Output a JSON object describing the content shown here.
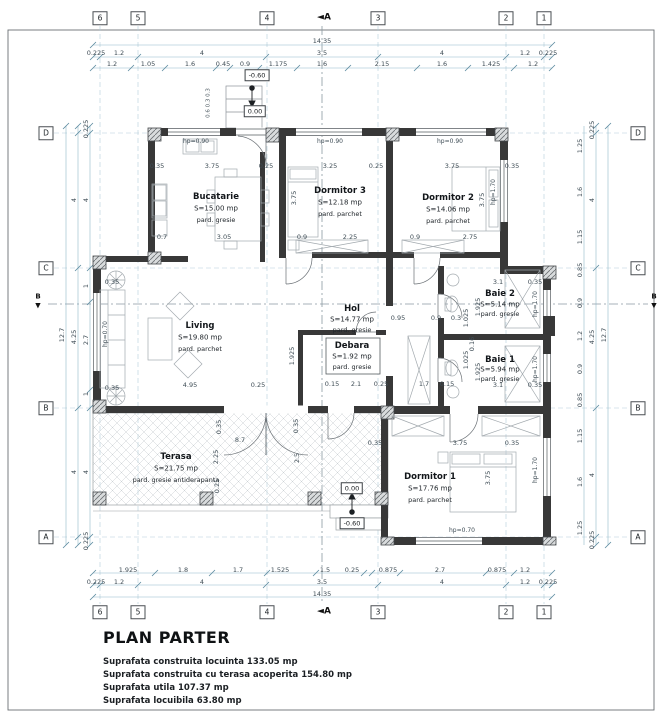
{
  "title_block": {
    "title": "PLAN PARTER",
    "lines": [
      "Suprafata construita locuinta 133.05 mp",
      "Suprafata construita cu terasa acoperita 154.80 mp",
      "Suprafata utila 107.37 mp",
      "Suprafata locuibila 63.80 mp"
    ]
  },
  "plan_labels": {
    "grid_bubbles": [
      {
        "t": "6",
        "x": 100,
        "y": 18
      },
      {
        "t": "5",
        "x": 138,
        "y": 18
      },
      {
        "t": "4",
        "x": 267,
        "y": 18
      },
      {
        "t": "3",
        "x": 378,
        "y": 18
      },
      {
        "t": "2",
        "x": 506,
        "y": 18
      },
      {
        "t": "1",
        "x": 544,
        "y": 18
      },
      {
        "t": "6",
        "x": 100,
        "y": 612
      },
      {
        "t": "5",
        "x": 138,
        "y": 612
      },
      {
        "t": "4",
        "x": 267,
        "y": 612
      },
      {
        "t": "3",
        "x": 378,
        "y": 612
      },
      {
        "t": "2",
        "x": 506,
        "y": 612
      },
      {
        "t": "1",
        "x": 544,
        "y": 612
      },
      {
        "t": "D",
        "x": 46,
        "y": 133
      },
      {
        "t": "C",
        "x": 46,
        "y": 268
      },
      {
        "t": "B",
        "x": 46,
        "y": 408
      },
      {
        "t": "A",
        "x": 46,
        "y": 537
      },
      {
        "t": "D",
        "x": 638,
        "y": 133
      },
      {
        "t": "C",
        "x": 638,
        "y": 268
      },
      {
        "t": "B",
        "x": 638,
        "y": 408
      },
      {
        "t": "A",
        "x": 638,
        "y": 537
      }
    ],
    "section_markers": [
      {
        "t": "◄A",
        "x": 324,
        "y": 18
      },
      {
        "t": "◄A",
        "x": 324,
        "y": 612
      }
    ],
    "section_small": [
      {
        "t": "B",
        "x": 38,
        "y": 297
      },
      {
        "t": "▼",
        "x": 38,
        "y": 306
      },
      {
        "t": "B",
        "x": 654,
        "y": 297
      },
      {
        "t": "▼",
        "x": 654,
        "y": 306
      }
    ],
    "room_names": [
      {
        "t": "Bucatarie",
        "x": 216,
        "y": 197
      },
      {
        "t": "Dormitor 3",
        "x": 340,
        "y": 191
      },
      {
        "t": "Dormitor 2",
        "x": 448,
        "y": 198
      },
      {
        "t": "Living",
        "x": 200,
        "y": 326
      },
      {
        "t": "Hol",
        "x": 352,
        "y": 309
      },
      {
        "t": "Debara",
        "x": 352,
        "y": 346
      },
      {
        "t": "Baie 2",
        "x": 500,
        "y": 294
      },
      {
        "t": "Baie 1",
        "x": 500,
        "y": 360
      },
      {
        "t": "Dormitor 1",
        "x": 430,
        "y": 477
      },
      {
        "t": "Terasa",
        "x": 176,
        "y": 457
      }
    ],
    "room_areas": [
      {
        "t": "S=15.00 mp",
        "x": 216,
        "y": 209
      },
      {
        "t": "S=12.18 mp",
        "x": 340,
        "y": 203
      },
      {
        "t": "S=14.06 mp",
        "x": 448,
        "y": 210
      },
      {
        "t": "S=19.80 mp",
        "x": 200,
        "y": 338
      },
      {
        "t": "S=14.77 mp",
        "x": 352,
        "y": 320
      },
      {
        "t": "S=1.92 mp",
        "x": 352,
        "y": 357
      },
      {
        "t": "S=5.14 mp",
        "x": 500,
        "y": 305
      },
      {
        "t": "S=5.94 mp",
        "x": 500,
        "y": 370
      },
      {
        "t": "S=17.76 mp",
        "x": 430,
        "y": 489
      },
      {
        "t": "S=21.75 mp",
        "x": 176,
        "y": 469
      }
    ],
    "room_floors": [
      {
        "t": "pard. gresie",
        "x": 216,
        "y": 220
      },
      {
        "t": "pard. parchet",
        "x": 340,
        "y": 214
      },
      {
        "t": "pard. parchet",
        "x": 448,
        "y": 221
      },
      {
        "t": "pard. parchet",
        "x": 200,
        "y": 349
      },
      {
        "t": "pard. gresie",
        "x": 352,
        "y": 330
      },
      {
        "t": "pard. gresie",
        "x": 352,
        "y": 367
      },
      {
        "t": "pard. gresie",
        "x": 500,
        "y": 314
      },
      {
        "t": "pard. gresie",
        "x": 500,
        "y": 379
      },
      {
        "t": "pard. parchet",
        "x": 430,
        "y": 500
      },
      {
        "t": "pard. gresie antiderapanta",
        "x": 176,
        "y": 480
      }
    ],
    "hp_labels": [
      {
        "t": "hp=0.90",
        "x": 196,
        "y": 142
      },
      {
        "t": "hp=0.90",
        "x": 330,
        "y": 142
      },
      {
        "t": "hp=0.90",
        "x": 450,
        "y": 142
      },
      {
        "t": "hp=1.70",
        "x": 494,
        "y": 192,
        "r": 1
      },
      {
        "t": "hp=1.70",
        "x": 536,
        "y": 304,
        "r": 1
      },
      {
        "t": "hp=1.70",
        "x": 536,
        "y": 369,
        "r": 1
      },
      {
        "t": "hp=1.70",
        "x": 536,
        "y": 470,
        "r": 1
      },
      {
        "t": "hp=0.70",
        "x": 462,
        "y": 531
      },
      {
        "t": "hp=0.70",
        "x": 106,
        "y": 334,
        "r": 1
      }
    ],
    "elev_labels": [
      {
        "t": "-0.60",
        "x": 257,
        "y": 75
      },
      {
        "t": "0.00",
        "x": 255,
        "y": 111
      },
      {
        "t": "0.00",
        "x": 352,
        "y": 488
      },
      {
        "t": "-0.60",
        "x": 352,
        "y": 523
      }
    ],
    "annotations": [
      {
        "t": "0.6  0.3 0.3",
        "x": 209,
        "y": 103,
        "r": 1
      }
    ],
    "dims": [
      {
        "t": "14.35",
        "x": 322,
        "y": 41
      },
      {
        "t": "0.225",
        "x": 96,
        "y": 53
      },
      {
        "t": "1.2",
        "x": 119,
        "y": 53
      },
      {
        "t": "4",
        "x": 202,
        "y": 53
      },
      {
        "t": "3.5",
        "x": 322,
        "y": 53
      },
      {
        "t": "4",
        "x": 442,
        "y": 53
      },
      {
        "t": "1.2",
        "x": 525,
        "y": 53
      },
      {
        "t": "0.225",
        "x": 548,
        "y": 53
      },
      {
        "t": "1.2",
        "x": 112,
        "y": 64
      },
      {
        "t": "1.05",
        "x": 148,
        "y": 64
      },
      {
        "t": "1.6",
        "x": 190,
        "y": 64
      },
      {
        "t": "0.45",
        "x": 223,
        "y": 64
      },
      {
        "t": "0.9",
        "x": 245,
        "y": 64
      },
      {
        "t": "1.175",
        "x": 278,
        "y": 64
      },
      {
        "t": "1.6",
        "x": 322,
        "y": 64
      },
      {
        "t": "2.15",
        "x": 382,
        "y": 64
      },
      {
        "t": "1.6",
        "x": 442,
        "y": 64
      },
      {
        "t": "1.425",
        "x": 491,
        "y": 64
      },
      {
        "t": "1.2",
        "x": 533,
        "y": 64
      },
      {
        "t": "1.925",
        "x": 128,
        "y": 570
      },
      {
        "t": "1.8",
        "x": 183,
        "y": 570
      },
      {
        "t": "1.7",
        "x": 238,
        "y": 570
      },
      {
        "t": "1.525",
        "x": 280,
        "y": 570
      },
      {
        "t": "1.5",
        "x": 325,
        "y": 570
      },
      {
        "t": "0.25",
        "x": 352,
        "y": 570
      },
      {
        "t": "0.875",
        "x": 388,
        "y": 570
      },
      {
        "t": "2.7",
        "x": 440,
        "y": 570
      },
      {
        "t": "0.875",
        "x": 497,
        "y": 570
      },
      {
        "t": "1.2",
        "x": 525,
        "y": 570
      },
      {
        "t": "0.225",
        "x": 96,
        "y": 582
      },
      {
        "t": "1.2",
        "x": 119,
        "y": 582
      },
      {
        "t": "4",
        "x": 202,
        "y": 582
      },
      {
        "t": "3.5",
        "x": 322,
        "y": 582
      },
      {
        "t": "4",
        "x": 442,
        "y": 582
      },
      {
        "t": "1.2",
        "x": 525,
        "y": 582
      },
      {
        "t": "0.225",
        "x": 548,
        "y": 582
      },
      {
        "t": "14.35",
        "x": 322,
        "y": 594
      },
      {
        "t": "0.225",
        "x": 86,
        "y": 129,
        "r": 1
      },
      {
        "t": "4",
        "x": 86,
        "y": 200,
        "r": 1
      },
      {
        "t": "1",
        "x": 86,
        "y": 286,
        "r": 1
      },
      {
        "t": "2.7",
        "x": 86,
        "y": 340,
        "r": 1
      },
      {
        "t": "1",
        "x": 86,
        "y": 394,
        "r": 1
      },
      {
        "t": "4",
        "x": 86,
        "y": 472,
        "r": 1
      },
      {
        "t": "0.225",
        "x": 86,
        "y": 541,
        "r": 1
      },
      {
        "t": "4",
        "x": 74,
        "y": 200,
        "r": 1
      },
      {
        "t": "4.25",
        "x": 74,
        "y": 337,
        "r": 1
      },
      {
        "t": "4",
        "x": 74,
        "y": 472,
        "r": 1
      },
      {
        "t": "12.7",
        "x": 62,
        "y": 335,
        "r": 1
      },
      {
        "t": "1.25",
        "x": 580,
        "y": 146,
        "r": 1
      },
      {
        "t": "1.6",
        "x": 580,
        "y": 192,
        "r": 1
      },
      {
        "t": "1.15",
        "x": 580,
        "y": 237,
        "r": 1
      },
      {
        "t": "0.85",
        "x": 580,
        "y": 270,
        "r": 1
      },
      {
        "t": "0.9",
        "x": 580,
        "y": 303,
        "r": 1
      },
      {
        "t": "1.2",
        "x": 580,
        "y": 336,
        "r": 1
      },
      {
        "t": "0.9",
        "x": 580,
        "y": 369,
        "r": 1
      },
      {
        "t": "0.85",
        "x": 580,
        "y": 400,
        "r": 1
      },
      {
        "t": "1.15",
        "x": 580,
        "y": 436,
        "r": 1
      },
      {
        "t": "1.6",
        "x": 580,
        "y": 482,
        "r": 1
      },
      {
        "t": "1.25",
        "x": 580,
        "y": 528,
        "r": 1
      },
      {
        "t": "0.225",
        "x": 592,
        "y": 130,
        "r": 1
      },
      {
        "t": "4",
        "x": 592,
        "y": 200,
        "r": 1
      },
      {
        "t": "4.25",
        "x": 592,
        "y": 337,
        "r": 1
      },
      {
        "t": "4",
        "x": 592,
        "y": 475,
        "r": 1
      },
      {
        "t": "0.225",
        "x": 592,
        "y": 540,
        "r": 1
      },
      {
        "t": "12.7",
        "x": 604,
        "y": 335,
        "r": 1
      },
      {
        "t": "0.35",
        "x": 157,
        "y": 166
      },
      {
        "t": "3.75",
        "x": 212,
        "y": 166
      },
      {
        "t": "0.25",
        "x": 266,
        "y": 166
      },
      {
        "t": "0.7",
        "x": 162,
        "y": 237
      },
      {
        "t": "3.05",
        "x": 224,
        "y": 237
      },
      {
        "t": "3.25",
        "x": 330,
        "y": 166
      },
      {
        "t": "0.25",
        "x": 376,
        "y": 166
      },
      {
        "t": "3.75",
        "x": 294,
        "y": 198,
        "r": 1
      },
      {
        "t": "0.9",
        "x": 302,
        "y": 237
      },
      {
        "t": "2.25",
        "x": 350,
        "y": 237
      },
      {
        "t": "3.75",
        "x": 452,
        "y": 166
      },
      {
        "t": "0.35",
        "x": 512,
        "y": 166
      },
      {
        "t": "0.9",
        "x": 415,
        "y": 237
      },
      {
        "t": "2.75",
        "x": 470,
        "y": 237
      },
      {
        "t": "3.75",
        "x": 482,
        "y": 200,
        "r": 1
      },
      {
        "t": "0.35",
        "x": 112,
        "y": 282
      },
      {
        "t": "4.95",
        "x": 190,
        "y": 385
      },
      {
        "t": "0.25",
        "x": 258,
        "y": 385
      },
      {
        "t": "0.35",
        "x": 112,
        "y": 388
      },
      {
        "t": "0.95",
        "x": 398,
        "y": 318
      },
      {
        "t": "0.9",
        "x": 436,
        "y": 318
      },
      {
        "t": "0.3",
        "x": 456,
        "y": 318
      },
      {
        "t": "0.15",
        "x": 332,
        "y": 384
      },
      {
        "t": "2.1",
        "x": 356,
        "y": 384
      },
      {
        "t": "0.25",
        "x": 381,
        "y": 384
      },
      {
        "t": "1.7",
        "x": 424,
        "y": 384
      },
      {
        "t": "0.15",
        "x": 447,
        "y": 384
      },
      {
        "t": "1.925",
        "x": 292,
        "y": 356,
        "r": 1
      },
      {
        "t": "3.1",
        "x": 498,
        "y": 282
      },
      {
        "t": "0.35",
        "x": 535,
        "y": 282
      },
      {
        "t": "3.1",
        "x": 498,
        "y": 385
      },
      {
        "t": "0.35",
        "x": 535,
        "y": 385
      },
      {
        "t": "1.925",
        "x": 478,
        "y": 307,
        "r": 1
      },
      {
        "t": "1.025",
        "x": 466,
        "y": 318,
        "r": 1
      },
      {
        "t": "0.16",
        "x": 472,
        "y": 344,
        "r": 1
      },
      {
        "t": "1.025",
        "x": 466,
        "y": 360,
        "r": 1
      },
      {
        "t": "1.925",
        "x": 478,
        "y": 372,
        "r": 1
      },
      {
        "t": "0.35",
        "x": 375,
        "y": 443
      },
      {
        "t": "3.75",
        "x": 460,
        "y": 443
      },
      {
        "t": "0.35",
        "x": 512,
        "y": 443
      },
      {
        "t": "3.75",
        "x": 488,
        "y": 478,
        "r": 1
      },
      {
        "t": "8.7",
        "x": 240,
        "y": 440
      },
      {
        "t": "0.35",
        "x": 219,
        "y": 427,
        "r": 1
      },
      {
        "t": "2.25",
        "x": 216,
        "y": 457,
        "r": 1
      },
      {
        "t": "0.25",
        "x": 217,
        "y": 486,
        "r": 1
      },
      {
        "t": "0.35",
        "x": 296,
        "y": 426,
        "r": 1
      },
      {
        "t": "2.5",
        "x": 297,
        "y": 458,
        "r": 1
      }
    ]
  }
}
